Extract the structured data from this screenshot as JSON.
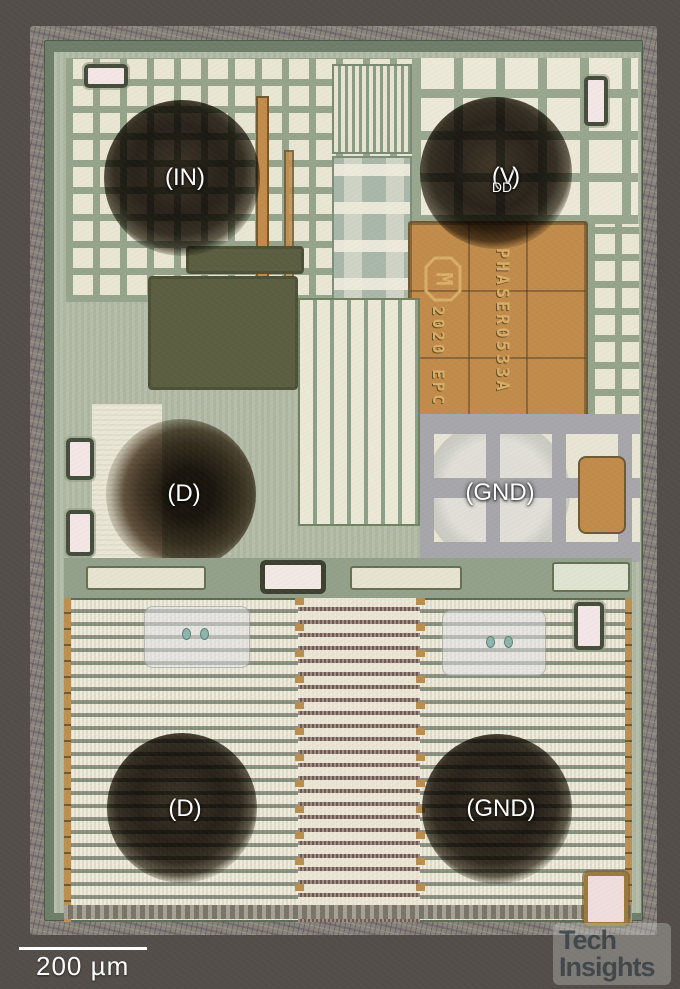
{
  "photo": {
    "type": "integrated-circuit die photograph",
    "colors": {
      "background": "#534e49",
      "die_surface": "#b2bba6",
      "seal_ring": "#6e7e69",
      "copper_metal": "#c18c4b",
      "bond_pad_dark": "#2c2620",
      "annotation_text": "#ffffff",
      "die_marking_text": "#d9af68"
    }
  },
  "pad_labels": {
    "in": "(IN)",
    "vdd": {
      "pre": "(V",
      "sub": "DD",
      "post": ")"
    },
    "d_mid": "(D)",
    "gnd_mid": "(GND)",
    "d_bottom": "(D)",
    "gnd_bottom": "(GND)"
  },
  "die_markings": {
    "logo_letter": "M",
    "year_line": "2020 EPC",
    "part_number": "PHASER0533A"
  },
  "scale_bar": {
    "label": "200 µm"
  },
  "watermark": {
    "line1": "Tech",
    "line2": "Insights"
  }
}
